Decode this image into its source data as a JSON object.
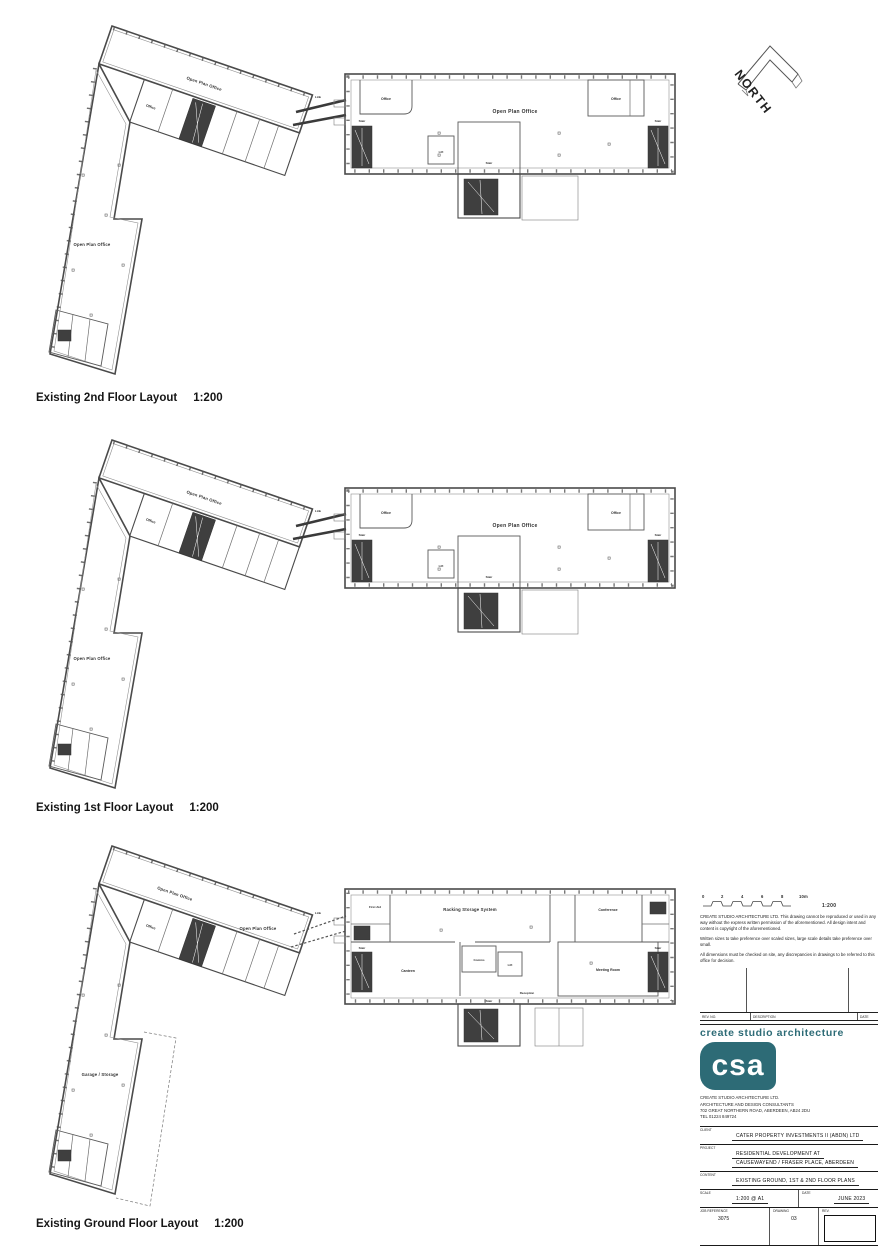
{
  "north": {
    "label": "NORTH"
  },
  "plans": [
    {
      "caption": "Existing 2nd Floor Layout",
      "scale": "1:200",
      "left": {
        "bar": "Open Plan Office",
        "office": "Office",
        "wing": "Open Plan Office"
      },
      "link": "Link",
      "right": {
        "office_left": "Office",
        "office_right": "Office",
        "open_plan": "Open Plan Office",
        "lift": "Lift",
        "stair": "Stair",
        "stair_left": "Stair",
        "stair_right": "Stair"
      }
    },
    {
      "caption": "Existing 1st Floor Layout",
      "scale": "1:200",
      "left": {
        "bar": "Open Plan Office",
        "office": "Office",
        "wing": "Open Plan Office"
      },
      "link": "Link",
      "right": {
        "office_left": "Office",
        "office_right": "Office",
        "open_plan": "Open Plan Office",
        "lift": "Lift",
        "stair": "Stair",
        "stair_left": "Stair",
        "stair_right": "Stair"
      }
    },
    {
      "caption": "Existing Ground Floor Layout",
      "scale": "1:200",
      "left": {
        "bar": "Open Plan Office",
        "mid": "Open Plan Office",
        "office": "Office",
        "wing": "Garage / Storage"
      },
      "link": "Link",
      "right": {
        "first_aid": "First Aid",
        "storage": "Racking Storage System",
        "conference": "Conference",
        "canteen": "Canteen",
        "comms": "Comms",
        "lift": "Lift",
        "meeting": "Meeting Room",
        "reception": "Reception",
        "stair": "Stair",
        "stair_left": "Stair",
        "stair_right": "Stair"
      }
    }
  ],
  "title_block": {
    "scale_bar": {
      "ticks": [
        "0",
        "2",
        "4",
        "6",
        "8",
        "10m"
      ],
      "ratio": "1:200"
    },
    "notes": [
      "CREATE STUDIO ARCHITECTURE LTD. This drawing cannot be reproduced or used in any way without the express written permission of the aforementioned. All design intent and content is copyright of the aforementioned.",
      "Written sizes to take preference over scaled sizes, large scale details take preference over small.",
      "All dimensions must be checked on site, any discrepancies in drawings to be referred to this office for decision."
    ],
    "revision": {
      "headers": [
        "REV. NO.",
        "DESCRIPTION",
        "DATE"
      ]
    },
    "brand": {
      "script": "create studio architecture",
      "logo": "csa"
    },
    "practice": {
      "line1": "CREATE STUDIO ARCHITECTURE LTD.",
      "line2": "ARCHITECTURE AND DESIGN CONSULTANTS",
      "line3": "702 GREAT NORTHERN ROAD,   ABERDEEN,   AB24 2DU",
      "line4": "TEL 01224 849724"
    },
    "fields": {
      "client_label": "CLIENT",
      "client": "CATER PROPERTY INVESTMENTS II (ABDN) LTD",
      "project_label": "PROJECT",
      "project1": "RESIDENTIAL DEVELOPMENT AT",
      "project2": "CAUSEWAYEND / FRASER PLACE, ABERDEEN",
      "content_label": "CONTENT",
      "content": "EXISTING GROUND, 1ST & 2ND FLOOR PLANS",
      "scale_label": "SCALE",
      "scale": "1:200 @ A1",
      "date_label": "DATE",
      "date": "JUNE 2023",
      "job_label": "JOB REFERENCE",
      "job": "3075",
      "drawing_label": "DRAWING",
      "drawing": "03",
      "rev_label": "REV."
    }
  }
}
